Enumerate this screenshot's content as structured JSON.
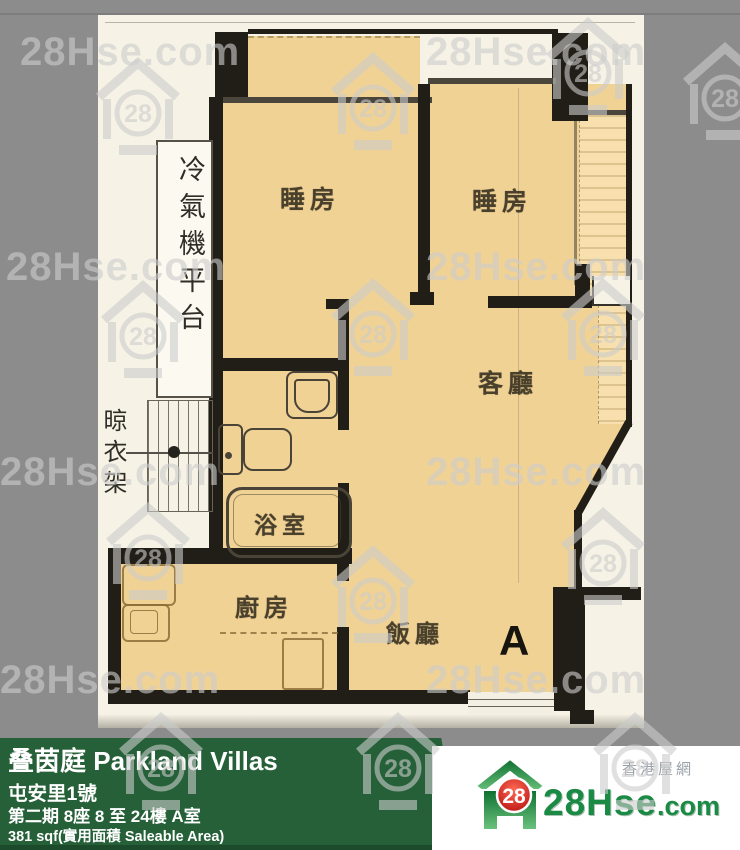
{
  "watermark": {
    "text": "28Hse.com",
    "logo_number": "28"
  },
  "floor_plan": {
    "unit_label": "A",
    "rooms": [
      {
        "id": "bedroom-1",
        "label": "睡房"
      },
      {
        "id": "bedroom-2",
        "label": "睡房"
      },
      {
        "id": "living-room",
        "label": "客廳"
      },
      {
        "id": "dining-room",
        "label": "飯廳"
      },
      {
        "id": "kitchen",
        "label": "廚房"
      },
      {
        "id": "bathroom",
        "label": "浴室"
      },
      {
        "id": "ac-platform",
        "label": "冷氣機平台"
      },
      {
        "id": "drying-rack",
        "label": "晾衣架"
      }
    ]
  },
  "info_bar": {
    "estate_name": "叠茵庭 Parkland Villas",
    "address": "屯安里1號",
    "phase_block_floor_unit": "第二期 8座 8 至 24樓 A室",
    "area": "381 sqf(實用面積 Saleable Area)"
  },
  "branding": {
    "site_name_main": "28Hse",
    "site_name_suffix": ".com",
    "tagline": "香港屋網",
    "logo_number": "28"
  },
  "colors": {
    "info_bar_green": "#256038",
    "brand_green": "#1a8a45",
    "logo_red": "#c61414",
    "room_fill": "#f1d295",
    "wall": "#211e17",
    "paper": "#f6f3e6",
    "background_gray": "#8c8c8c"
  }
}
